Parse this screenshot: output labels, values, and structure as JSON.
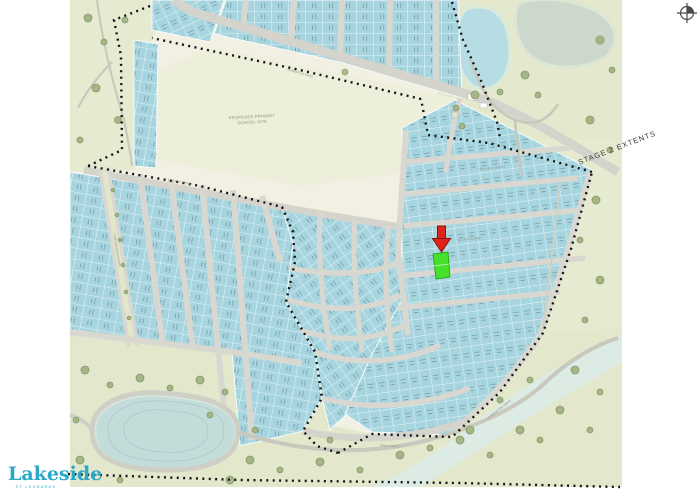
{
  "logo": {
    "wordmark": "Lakeside",
    "tagline": "· ST LEONARDS ·"
  },
  "map": {
    "stage_label": "STAGE 2 EXTENTS",
    "school_site": {
      "line1": "PROPOSED PRIMARY",
      "line2": "SCHOOL SITE"
    },
    "street_labels": [
      "SOMERTON ROAD",
      "HOLLAND STREET",
      "WALKER STREET",
      "KING STREET",
      "LAKESIDE BOULEVARD",
      "STATION STREET",
      "FORESHORE DRIVE"
    ],
    "icons": {
      "north_arrow": "compass-crosshair",
      "lot_pointer": "red-down-arrow"
    },
    "colors": {
      "lot_fill": "#a6d5df",
      "street_gray": "#d8d8d1",
      "land_cream": "#f1f0e2",
      "park_green": "#e7ebd3",
      "school_field": "#edefdb",
      "water_blue": "#b7dde4",
      "lake_blue": "#c3dcda",
      "highlight_green": "#46e12b",
      "arrow_red": "#e02318",
      "boundary_black": "#141414",
      "logo_blue": "#2aa8c8"
    }
  }
}
